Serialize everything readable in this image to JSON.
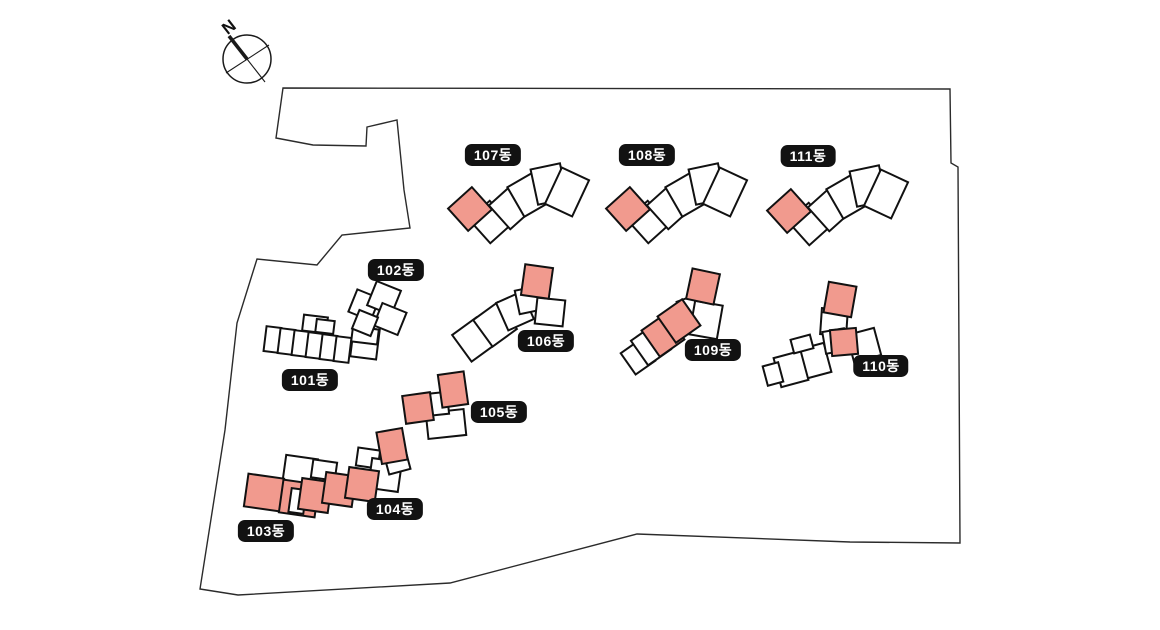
{
  "compass": {
    "label": "N"
  },
  "colors": {
    "highlight": "#F19A8E",
    "building_fill": "#FFFFFF",
    "outline": "#111111",
    "boundary": "#2b2b2b",
    "label_bg": "#121212",
    "label_text": "#FFFFFF"
  },
  "buildings": [
    {
      "id": "101",
      "label": "101동",
      "label_pos": {
        "x": 310,
        "y": 380
      },
      "units": [
        [
          303,
          316,
          24,
          16,
          7,
          0
        ],
        [
          316,
          320,
          18,
          13,
          7,
          0
        ],
        [
          265,
          327,
          15,
          25,
          7,
          0
        ],
        [
          279,
          329,
          15,
          25,
          7,
          0
        ],
        [
          293,
          331,
          15,
          25,
          7,
          0
        ],
        [
          307,
          333,
          15,
          25,
          7,
          0
        ],
        [
          321,
          335,
          15,
          25,
          7,
          0
        ],
        [
          335,
          337,
          15,
          25,
          7,
          0
        ],
        [
          352,
          328,
          26,
          30,
          7,
          0
        ],
        [
          352,
          328,
          26,
          15,
          7,
          0
        ]
      ]
    },
    {
      "id": "102",
      "label": "102동",
      "label_pos": {
        "x": 396,
        "y": 270
      },
      "units": [
        [
          352,
          293,
          24,
          24,
          22,
          0
        ],
        [
          371,
          285,
          26,
          26,
          22,
          0
        ],
        [
          377,
          307,
          26,
          24,
          22,
          0
        ],
        [
          355,
          313,
          20,
          20,
          22,
          0
        ]
      ]
    },
    {
      "id": "103",
      "label": "103동",
      "label_pos": {
        "x": 266,
        "y": 531
      },
      "units": [
        [
          284,
          457,
          32,
          30,
          8,
          0
        ],
        [
          246,
          476,
          36,
          33,
          8,
          1
        ],
        [
          281,
          482,
          36,
          33,
          8,
          1
        ]
      ]
    },
    {
      "id": "104",
      "label": "104동",
      "label_pos": {
        "x": 395,
        "y": 509
      },
      "units": [
        [
          312,
          461,
          24,
          18,
          8,
          0
        ],
        [
          357,
          449,
          22,
          18,
          8,
          0
        ],
        [
          290,
          489,
          15,
          24,
          8,
          0
        ],
        [
          370,
          460,
          30,
          30,
          8,
          0
        ],
        [
          386,
          450,
          22,
          22,
          -15,
          0
        ],
        [
          300,
          480,
          30,
          31,
          8,
          1
        ],
        [
          324,
          474,
          30,
          31,
          8,
          1
        ],
        [
          347,
          469,
          30,
          31,
          8,
          1
        ],
        [
          379,
          430,
          26,
          32,
          -10,
          1
        ]
      ]
    },
    {
      "id": "105",
      "label": "105동",
      "label_pos": {
        "x": 499,
        "y": 412
      },
      "units": [
        [
          427,
          411,
          38,
          26,
          -6,
          0
        ],
        [
          424,
          393,
          24,
          22,
          -6,
          0
        ],
        [
          404,
          394,
          28,
          28,
          -8,
          1
        ],
        [
          440,
          373,
          26,
          33,
          -8,
          1
        ]
      ]
    },
    {
      "id": "106",
      "label": "106동",
      "label_pos": {
        "x": 546,
        "y": 341
      },
      "units": [
        [
          459,
          323,
          30,
          33,
          -36,
          0
        ],
        [
          480,
          308,
          30,
          33,
          -36,
          0
        ],
        [
          501,
          296,
          28,
          30,
          -24,
          0
        ],
        [
          517,
          288,
          24,
          24,
          -12,
          0
        ],
        [
          536,
          299,
          28,
          26,
          6,
          0
        ],
        [
          523,
          266,
          28,
          31,
          8,
          1
        ]
      ]
    },
    {
      "id": "107",
      "label": "107동",
      "label_pos": {
        "x": 493,
        "y": 155
      },
      "units": [
        [
          476,
          206,
          28,
          32,
          -42,
          0
        ],
        [
          496,
          192,
          28,
          32,
          -42,
          0
        ],
        [
          514,
          178,
          28,
          34,
          -30,
          0
        ],
        [
          534,
          166,
          30,
          36,
          -12,
          0
        ],
        [
          552,
          172,
          30,
          40,
          25,
          0
        ],
        [
          454,
          194,
          32,
          30,
          -42,
          1
        ]
      ]
    },
    {
      "id": "108",
      "label": "108동",
      "label_pos": {
        "x": 647,
        "y": 155
      },
      "units": [
        [
          634,
          206,
          28,
          32,
          -42,
          0
        ],
        [
          654,
          192,
          28,
          32,
          -42,
          0
        ],
        [
          672,
          178,
          28,
          34,
          -30,
          0
        ],
        [
          692,
          166,
          30,
          36,
          -12,
          0
        ],
        [
          710,
          172,
          30,
          40,
          25,
          0
        ],
        [
          612,
          194,
          32,
          30,
          -42,
          1
        ]
      ]
    },
    {
      "id": "109",
      "label": "109동",
      "label_pos": {
        "x": 713,
        "y": 350
      },
      "units": [
        [
          626,
          344,
          24,
          26,
          -35,
          0
        ],
        [
          637,
          330,
          28,
          30,
          -35,
          0
        ],
        [
          680,
          297,
          24,
          24,
          -20,
          0
        ],
        [
          692,
          303,
          28,
          34,
          10,
          0
        ],
        [
          648,
          319,
          30,
          32,
          -35,
          1
        ],
        [
          664,
          305,
          30,
          32,
          -35,
          1
        ],
        [
          689,
          271,
          28,
          31,
          12,
          1
        ]
      ]
    },
    {
      "id": "110",
      "label": "110동",
      "label_pos": {
        "x": 881,
        "y": 366
      },
      "units": [
        [
          850,
          331,
          28,
          28,
          -15,
          0
        ],
        [
          800,
          346,
          28,
          30,
          -15,
          0
        ],
        [
          777,
          354,
          28,
          30,
          -15,
          0
        ],
        [
          765,
          364,
          16,
          20,
          -15,
          0
        ],
        [
          792,
          337,
          20,
          14,
          -15,
          0
        ],
        [
          821,
          309,
          26,
          26,
          4,
          0
        ],
        [
          824,
          330,
          22,
          22,
          -10,
          0
        ],
        [
          826,
          284,
          28,
          31,
          10,
          1
        ],
        [
          831,
          329,
          26,
          26,
          -5,
          1
        ]
      ]
    },
    {
      "id": "111",
      "label": "111동",
      "label_pos": {
        "x": 808,
        "y": 156
      },
      "units": [
        [
          795,
          208,
          28,
          32,
          -42,
          0
        ],
        [
          815,
          194,
          28,
          32,
          -42,
          0
        ],
        [
          833,
          180,
          28,
          34,
          -30,
          0
        ],
        [
          853,
          168,
          30,
          36,
          -12,
          0
        ],
        [
          871,
          174,
          30,
          40,
          25,
          0
        ],
        [
          773,
          196,
          32,
          30,
          -42,
          1
        ]
      ]
    }
  ]
}
